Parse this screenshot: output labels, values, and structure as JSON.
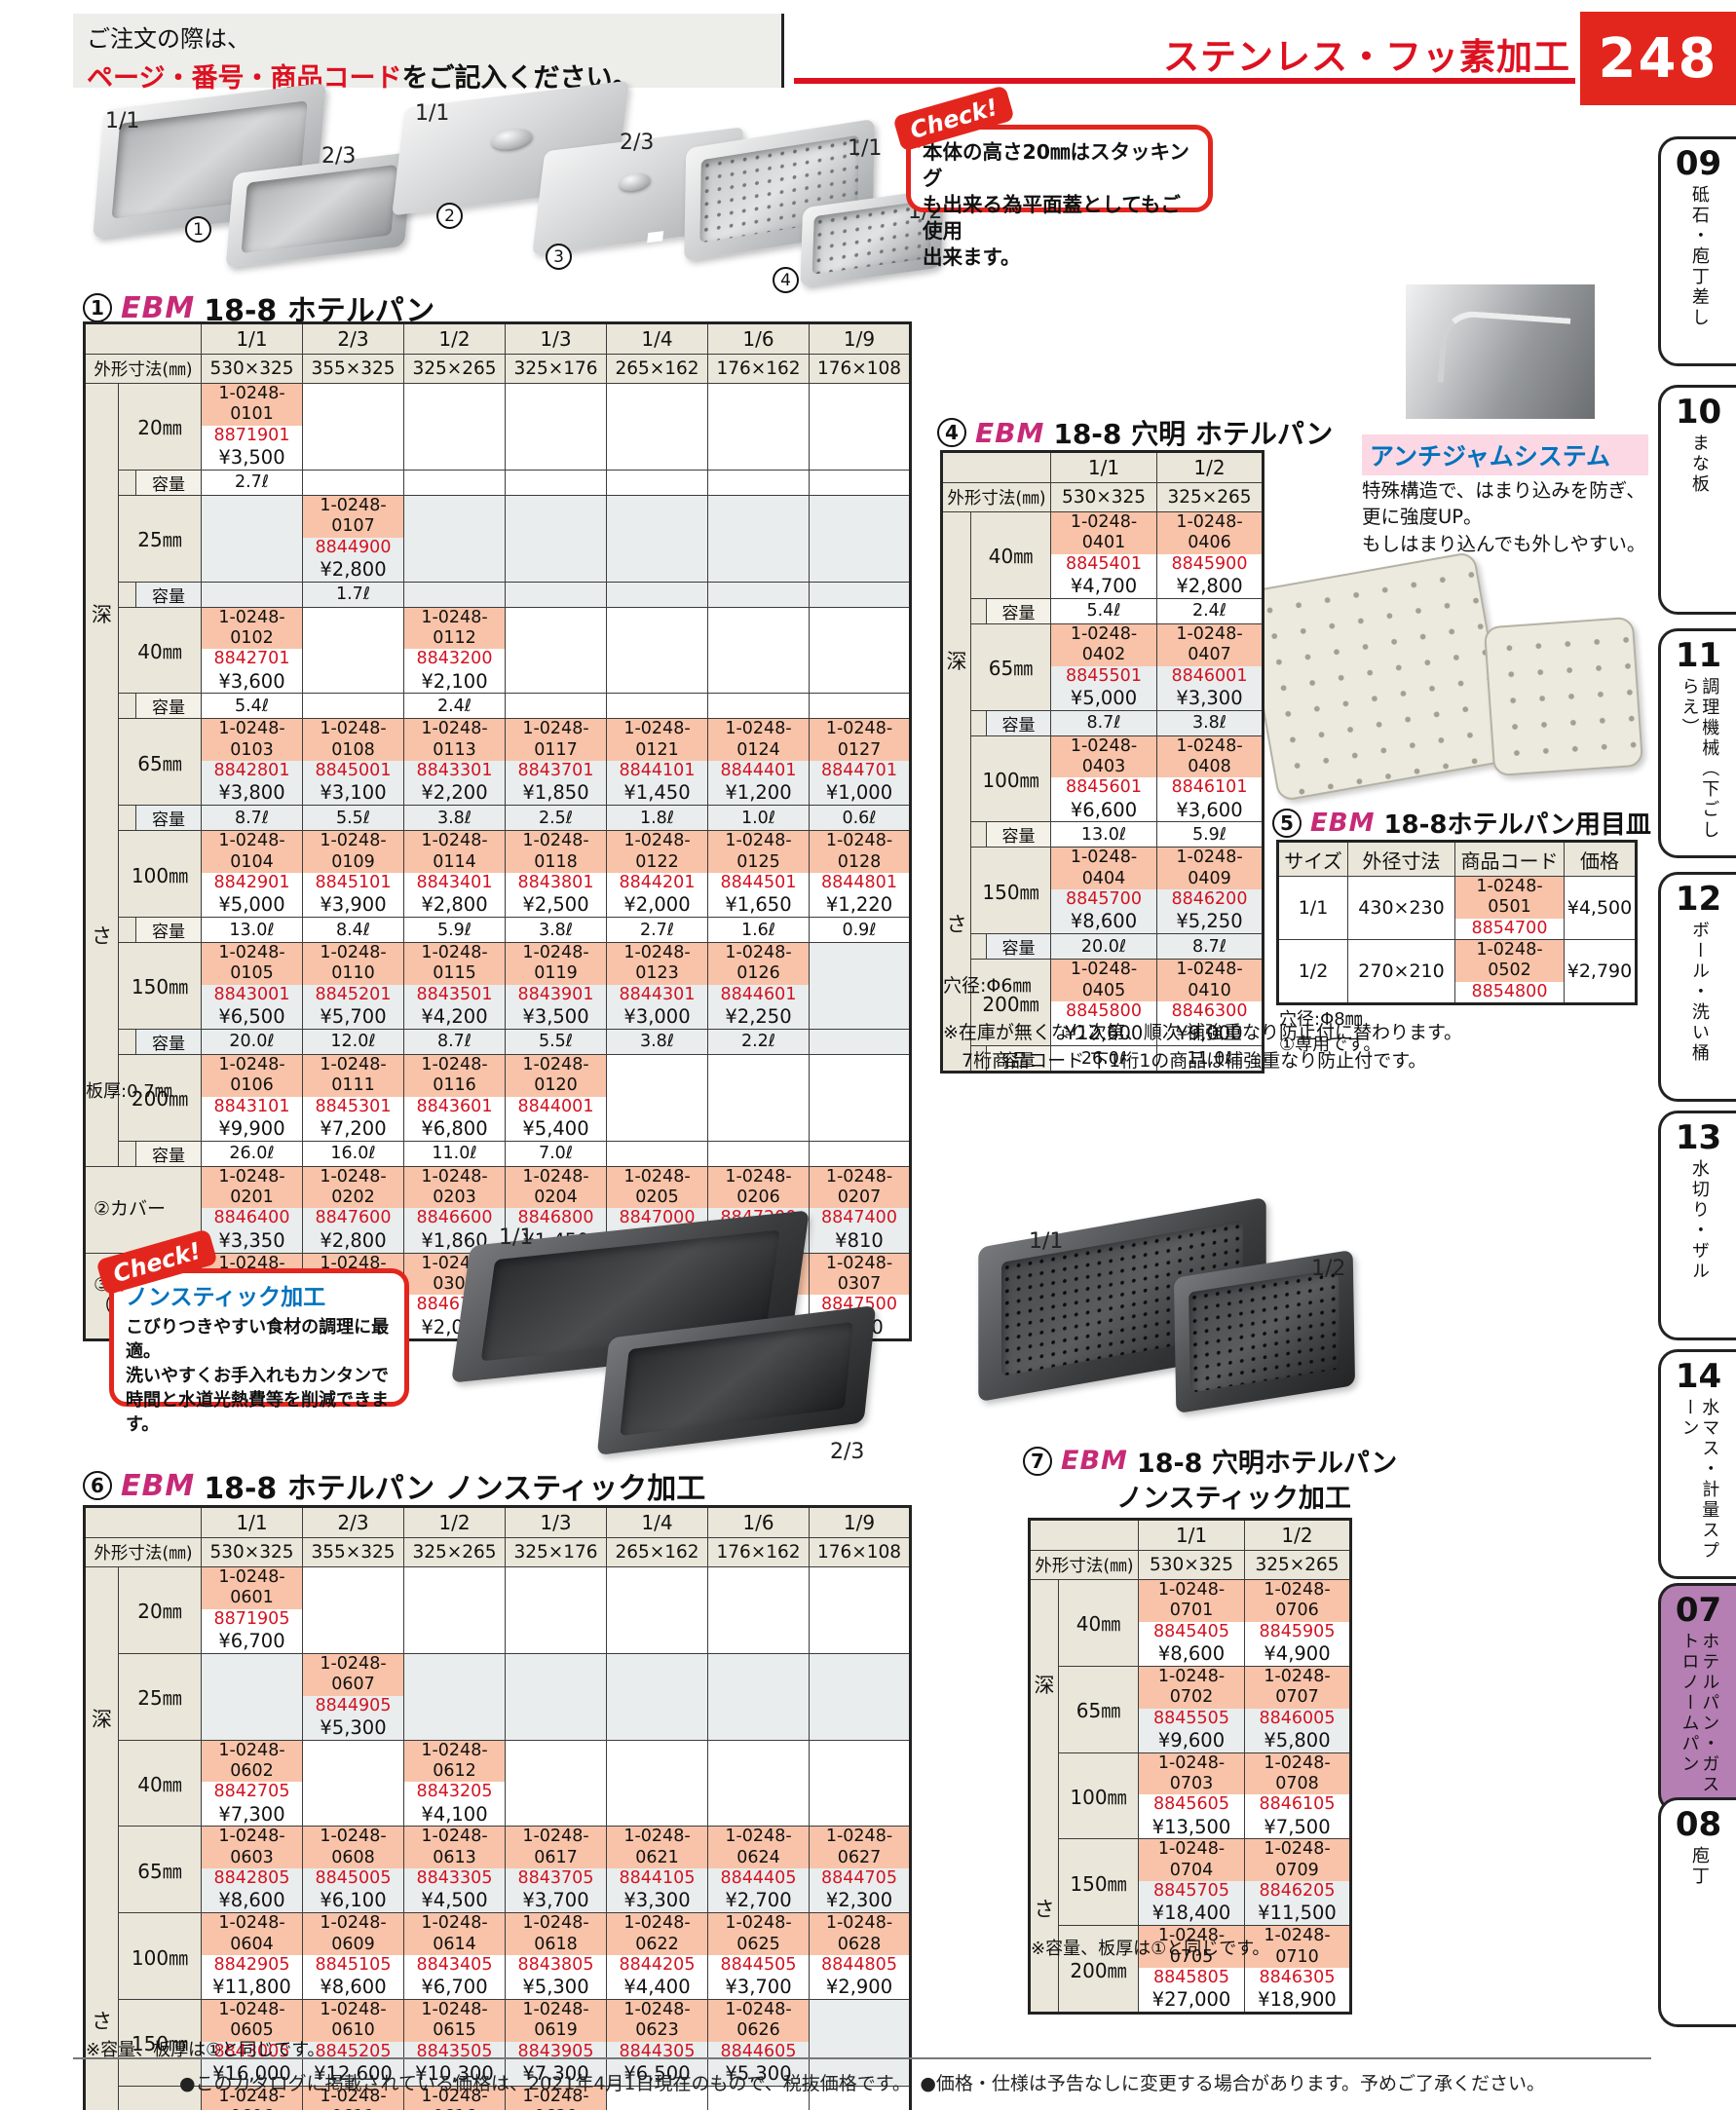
{
  "header": {
    "order1": "ご注文の際は、",
    "order2_red": "ページ・番号・商品コード",
    "order2_black": "をご記入ください。",
    "category": "ステンレス・フッ素加工",
    "page": "248"
  },
  "colors": {
    "accent_red": "#dd1120",
    "code_highlight": "#f8c3a8",
    "jan_red": "#d4121f",
    "label_beige": "#eae6d9",
    "row_alt": "#e9eded",
    "active_tab_purple": "#b57fb3",
    "heading_blue": "#0072bc",
    "ebm_magenta": "#c62a77"
  },
  "images": {
    "pan11": "1/1",
    "pan23": "2/3",
    "num1": "1",
    "lid11": "1/1",
    "num2": "2",
    "lid23": "2/3",
    "num3": "3",
    "perf11": "1/1",
    "perf12": "1/2",
    "num4": "4",
    "ns11": "1/1",
    "ns23": "2/3",
    "pns11": "1/1",
    "pns12": "1/2"
  },
  "check1": {
    "badge": "Check!",
    "text": "本体の高さ20㎜はスタッキング\nも出来る為平面蓋としてもご使用\n出来ます。"
  },
  "antijam": {
    "title": "アンチジャムシステム",
    "text": "特殊構造で、はまり込みを防ぎ、\n更に強度UP。\nもしはまり込んでも外しやすい。"
  },
  "check2": {
    "badge": "Check!",
    "title": "ノンスティック加工",
    "text": "こびりつきやすい食材の調理に最適。\n洗いやすくお手入れもカンタンで\n時間と水道光熱費等を削減できます。"
  },
  "table1": {
    "num": "1",
    "brand": "EBM",
    "title": "18-8 ホテルパン",
    "col_headers": [
      "1/1",
      "2/3",
      "1/2",
      "1/3",
      "1/4",
      "1/6",
      "1/9"
    ],
    "dim_label": "外形寸法(㎜)",
    "dims": [
      "530×325",
      "355×325",
      "325×265",
      "325×176",
      "265×162",
      "176×162",
      "176×108"
    ],
    "depth_label": "深さ",
    "capacity_label": "容量",
    "rows": [
      {
        "size": "20㎜",
        "cells": [
          [
            "1-0248-0101",
            "8871901",
            "¥3,500"
          ],
          null,
          null,
          null,
          null,
          null,
          null
        ],
        "caps": [
          "2.7ℓ",
          "",
          "",
          "",
          "",
          "",
          ""
        ]
      },
      {
        "size": "25㎜",
        "cells": [
          null,
          [
            "1-0248-0107",
            "8844900",
            "¥2,800"
          ],
          null,
          null,
          null,
          null,
          null
        ],
        "caps": [
          "",
          "1.7ℓ",
          "",
          "",
          "",
          "",
          ""
        ]
      },
      {
        "size": "40㎜",
        "cells": [
          [
            "1-0248-0102",
            "8842701",
            "¥3,600"
          ],
          null,
          [
            "1-0248-0112",
            "8843200",
            "¥2,100"
          ],
          null,
          null,
          null,
          null
        ],
        "caps": [
          "5.4ℓ",
          "",
          "2.4ℓ",
          "",
          "",
          "",
          ""
        ]
      },
      {
        "size": "65㎜",
        "cells": [
          [
            "1-0248-0103",
            "8842801",
            "¥3,800"
          ],
          [
            "1-0248-0108",
            "8845001",
            "¥3,100"
          ],
          [
            "1-0248-0113",
            "8843301",
            "¥2,200"
          ],
          [
            "1-0248-0117",
            "8843701",
            "¥1,850"
          ],
          [
            "1-0248-0121",
            "8844101",
            "¥1,450"
          ],
          [
            "1-0248-0124",
            "8844401",
            "¥1,200"
          ],
          [
            "1-0248-0127",
            "8844701",
            "¥1,000"
          ]
        ],
        "caps": [
          "8.7ℓ",
          "5.5ℓ",
          "3.8ℓ",
          "2.5ℓ",
          "1.8ℓ",
          "1.0ℓ",
          "0.6ℓ"
        ]
      },
      {
        "size": "100㎜",
        "cells": [
          [
            "1-0248-0104",
            "8842901",
            "¥5,000"
          ],
          [
            "1-0248-0109",
            "8845101",
            "¥3,900"
          ],
          [
            "1-0248-0114",
            "8843401",
            "¥2,800"
          ],
          [
            "1-0248-0118",
            "8843801",
            "¥2,500"
          ],
          [
            "1-0248-0122",
            "8844201",
            "¥2,000"
          ],
          [
            "1-0248-0125",
            "8844501",
            "¥1,650"
          ],
          [
            "1-0248-0128",
            "8844801",
            "¥1,220"
          ]
        ],
        "caps": [
          "13.0ℓ",
          "8.4ℓ",
          "5.9ℓ",
          "3.8ℓ",
          "2.7ℓ",
          "1.6ℓ",
          "0.9ℓ"
        ]
      },
      {
        "size": "150㎜",
        "cells": [
          [
            "1-0248-0105",
            "8843001",
            "¥6,500"
          ],
          [
            "1-0248-0110",
            "8845201",
            "¥5,700"
          ],
          [
            "1-0248-0115",
            "8843501",
            "¥4,200"
          ],
          [
            "1-0248-0119",
            "8843901",
            "¥3,500"
          ],
          [
            "1-0248-0123",
            "8844301",
            "¥3,000"
          ],
          [
            "1-0248-0126",
            "8844601",
            "¥2,250"
          ],
          null
        ],
        "caps": [
          "20.0ℓ",
          "12.0ℓ",
          "8.7ℓ",
          "5.5ℓ",
          "3.8ℓ",
          "2.2ℓ",
          ""
        ]
      },
      {
        "size": "200㎜",
        "cells": [
          [
            "1-0248-0106",
            "8843101",
            "¥9,900"
          ],
          [
            "1-0248-0111",
            "8845301",
            "¥7,200"
          ],
          [
            "1-0248-0116",
            "8843601",
            "¥6,800"
          ],
          [
            "1-0248-0120",
            "8844001",
            "¥5,400"
          ],
          null,
          null,
          null
        ],
        "caps": [
          "26.0ℓ",
          "16.0ℓ",
          "11.0ℓ",
          "7.0ℓ",
          "",
          "",
          ""
        ]
      }
    ],
    "cover_rows": [
      {
        "label": "②カバー",
        "cells": [
          [
            "1-0248-0201",
            "8846400",
            "¥3,350"
          ],
          [
            "1-0248-0202",
            "8847600",
            "¥2,800"
          ],
          [
            "1-0248-0203",
            "8846600",
            "¥1,860"
          ],
          [
            "1-0248-0204",
            "8846800",
            "¥1,450"
          ],
          [
            "1-0248-0205",
            "8847000",
            "¥1,260"
          ],
          [
            "1-0248-0206",
            "8847200",
            "¥900"
          ],
          [
            "1-0248-0207",
            "8847400",
            "¥810"
          ]
        ]
      },
      {
        "label": "③カバー\n（切込付）",
        "cells": [
          [
            "1-0248-0301",
            "8846500",
            "¥3,600"
          ],
          [
            "1-0248-0302",
            "8847700",
            "¥2,800"
          ],
          [
            "1-0248-0303",
            "8846700",
            "¥2,050"
          ],
          [
            "1-0248-0304",
            "8846900",
            "¥1,550"
          ],
          [
            "1-0248-0305",
            "8847100",
            "¥1,310"
          ],
          [
            "1-0248-0306",
            "8847300",
            "¥1,000"
          ],
          [
            "1-0248-0307",
            "8847500",
            "¥900"
          ]
        ]
      }
    ],
    "note": "板厚:0.7㎜"
  },
  "table4": {
    "num": "4",
    "brand": "EBM",
    "title": "18-8 穴明 ホテルパン",
    "col_headers": [
      "1/1",
      "1/2"
    ],
    "dim_label": "外形寸法(㎜)",
    "dims": [
      "530×325",
      "325×265"
    ],
    "depth_label": "深さ",
    "capacity_label": "容量",
    "rows": [
      {
        "size": "40㎜",
        "cells": [
          [
            "1-0248-0401",
            "8845401",
            "¥4,700"
          ],
          [
            "1-0248-0406",
            "8845900",
            "¥2,800"
          ]
        ],
        "caps": [
          "5.4ℓ",
          "2.4ℓ"
        ]
      },
      {
        "size": "65㎜",
        "cells": [
          [
            "1-0248-0402",
            "8845501",
            "¥5,000"
          ],
          [
            "1-0248-0407",
            "8846001",
            "¥3,300"
          ]
        ],
        "caps": [
          "8.7ℓ",
          "3.8ℓ"
        ]
      },
      {
        "size": "100㎜",
        "cells": [
          [
            "1-0248-0403",
            "8845601",
            "¥6,600"
          ],
          [
            "1-0248-0408",
            "8846101",
            "¥3,600"
          ]
        ],
        "caps": [
          "13.0ℓ",
          "5.9ℓ"
        ]
      },
      {
        "size": "150㎜",
        "cells": [
          [
            "1-0248-0404",
            "8845700",
            "¥8,600"
          ],
          [
            "1-0248-0409",
            "8846200",
            "¥5,250"
          ]
        ],
        "caps": [
          "20.0ℓ",
          "8.7ℓ"
        ]
      },
      {
        "size": "200㎜",
        "cells": [
          [
            "1-0248-0405",
            "8845800",
            "¥12,600"
          ],
          [
            "1-0248-0410",
            "8846300",
            "¥9,000"
          ]
        ],
        "caps": [
          "26.0ℓ",
          "11.0ℓ"
        ]
      }
    ],
    "note": "穴径:Φ6㎜",
    "extra_note": "※在庫が無くなり次第、順次 補強重なり防止付に替わります。\n　7桁商品コード 下1桁1の商品は補強重なり防止付です。"
  },
  "table5": {
    "num": "5",
    "brand": "EBM",
    "title": "18-8ホテルパン用目皿",
    "headers": [
      "サイズ",
      "外径寸法",
      "商品コード",
      "価格"
    ],
    "rows": [
      [
        "1/1",
        "430×230",
        "1-0248-0501",
        "8854700",
        "¥4,500"
      ],
      [
        "1/2",
        "270×210",
        "1-0248-0502",
        "8854800",
        "¥2,790"
      ]
    ],
    "note1": "穴径:Φ8㎜",
    "note2": "①専用です。"
  },
  "table6": {
    "num": "6",
    "brand": "EBM",
    "title": "18-8 ホテルパン ノンスティック加工",
    "col_headers": [
      "1/1",
      "2/3",
      "1/2",
      "1/3",
      "1/4",
      "1/6",
      "1/9"
    ],
    "dim_label": "外形寸法(㎜)",
    "dims": [
      "530×325",
      "355×325",
      "325×265",
      "325×176",
      "265×162",
      "176×162",
      "176×108"
    ],
    "depth_label": "深さ",
    "rows": [
      {
        "size": "20㎜",
        "cells": [
          [
            "1-0248-0601",
            "8871905",
            "¥6,700"
          ],
          null,
          null,
          null,
          null,
          null,
          null
        ]
      },
      {
        "size": "25㎜",
        "cells": [
          null,
          [
            "1-0248-0607",
            "8844905",
            "¥5,300"
          ],
          null,
          null,
          null,
          null,
          null
        ]
      },
      {
        "size": "40㎜",
        "cells": [
          [
            "1-0248-0602",
            "8842705",
            "¥7,300"
          ],
          null,
          [
            "1-0248-0612",
            "8843205",
            "¥4,100"
          ],
          null,
          null,
          null,
          null
        ]
      },
      {
        "size": "65㎜",
        "cells": [
          [
            "1-0248-0603",
            "8842805",
            "¥8,600"
          ],
          [
            "1-0248-0608",
            "8845005",
            "¥6,100"
          ],
          [
            "1-0248-0613",
            "8843305",
            "¥4,500"
          ],
          [
            "1-0248-0617",
            "8843705",
            "¥3,700"
          ],
          [
            "1-0248-0621",
            "8844105",
            "¥3,300"
          ],
          [
            "1-0248-0624",
            "8844405",
            "¥2,700"
          ],
          [
            "1-0248-0627",
            "8844705",
            "¥2,300"
          ]
        ]
      },
      {
        "size": "100㎜",
        "cells": [
          [
            "1-0248-0604",
            "8842905",
            "¥11,800"
          ],
          [
            "1-0248-0609",
            "8845105",
            "¥8,600"
          ],
          [
            "1-0248-0614",
            "8843405",
            "¥6,700"
          ],
          [
            "1-0248-0618",
            "8843805",
            "¥5,300"
          ],
          [
            "1-0248-0622",
            "8844205",
            "¥4,400"
          ],
          [
            "1-0248-0625",
            "8844505",
            "¥3,700"
          ],
          [
            "1-0248-0628",
            "8844805",
            "¥2,900"
          ]
        ]
      },
      {
        "size": "150㎜",
        "cells": [
          [
            "1-0248-0605",
            "8843005",
            "¥16,000"
          ],
          [
            "1-0248-0610",
            "8845205",
            "¥12,600"
          ],
          [
            "1-0248-0615",
            "8843505",
            "¥10,300"
          ],
          [
            "1-0248-0619",
            "8843905",
            "¥7,300"
          ],
          [
            "1-0248-0623",
            "8844305",
            "¥6,500"
          ],
          [
            "1-0248-0626",
            "8844605",
            "¥5,300"
          ],
          null
        ]
      },
      {
        "size": "200㎜",
        "cells": [
          [
            "1-0248-0606",
            "8843105",
            "¥24,000"
          ],
          [
            "1-0248-0611",
            "8845305",
            "¥17,500"
          ],
          [
            "1-0248-0616",
            "8843605",
            "¥16,400"
          ],
          [
            "1-0248-0620",
            "8844005",
            "¥12,000"
          ],
          null,
          null,
          null
        ]
      }
    ],
    "note": "※容量、板厚は①と同じです。"
  },
  "table7": {
    "num": "7",
    "brand": "EBM",
    "title": "18-8 穴明ホテルパン",
    "title2": "ノンスティック加工",
    "col_headers": [
      "1/1",
      "1/2"
    ],
    "dim_label": "外形寸法(㎜)",
    "dims": [
      "530×325",
      "325×265"
    ],
    "depth_label": "深さ",
    "rows": [
      {
        "size": "40㎜",
        "cells": [
          [
            "1-0248-0701",
            "8845405",
            "¥8,600"
          ],
          [
            "1-0248-0706",
            "8845905",
            "¥4,900"
          ]
        ]
      },
      {
        "size": "65㎜",
        "cells": [
          [
            "1-0248-0702",
            "8845505",
            "¥9,600"
          ],
          [
            "1-0248-0707",
            "8846005",
            "¥5,800"
          ]
        ]
      },
      {
        "size": "100㎜",
        "cells": [
          [
            "1-0248-0703",
            "8845605",
            "¥13,500"
          ],
          [
            "1-0248-0708",
            "8846105",
            "¥7,500"
          ]
        ]
      },
      {
        "size": "150㎜",
        "cells": [
          [
            "1-0248-0704",
            "8845705",
            "¥18,400"
          ],
          [
            "1-0248-0709",
            "8846205",
            "¥11,500"
          ]
        ]
      },
      {
        "size": "200㎜",
        "cells": [
          [
            "1-0248-0705",
            "8845805",
            "¥27,000"
          ],
          [
            "1-0248-0710",
            "8846305",
            "¥18,900"
          ]
        ]
      }
    ],
    "note": "※容量、板厚は①と同じです。"
  },
  "sidebar": {
    "tabs": [
      {
        "num": "09",
        "label": "砥石・庖丁差し"
      },
      {
        "num": "10",
        "label": "まな板"
      },
      {
        "num": "11",
        "label": "調理機械（下ごしらえ）"
      },
      {
        "num": "12",
        "label": "ボール・洗い桶"
      },
      {
        "num": "13",
        "label": "水切り・ザル"
      },
      {
        "num": "14",
        "label": "水マス・計量スプーン"
      },
      {
        "num": "07",
        "label": "ホテルパン・ガストロノームパン",
        "active": true
      },
      {
        "num": "08",
        "label": "庖丁"
      }
    ]
  },
  "footer": {
    "text": "●このカタログに掲載されている価格は、2021年4月1日現在のもので、税抜価格です。　●価格・仕様は予告なしに変更する場合があります。予めご了承ください。"
  }
}
